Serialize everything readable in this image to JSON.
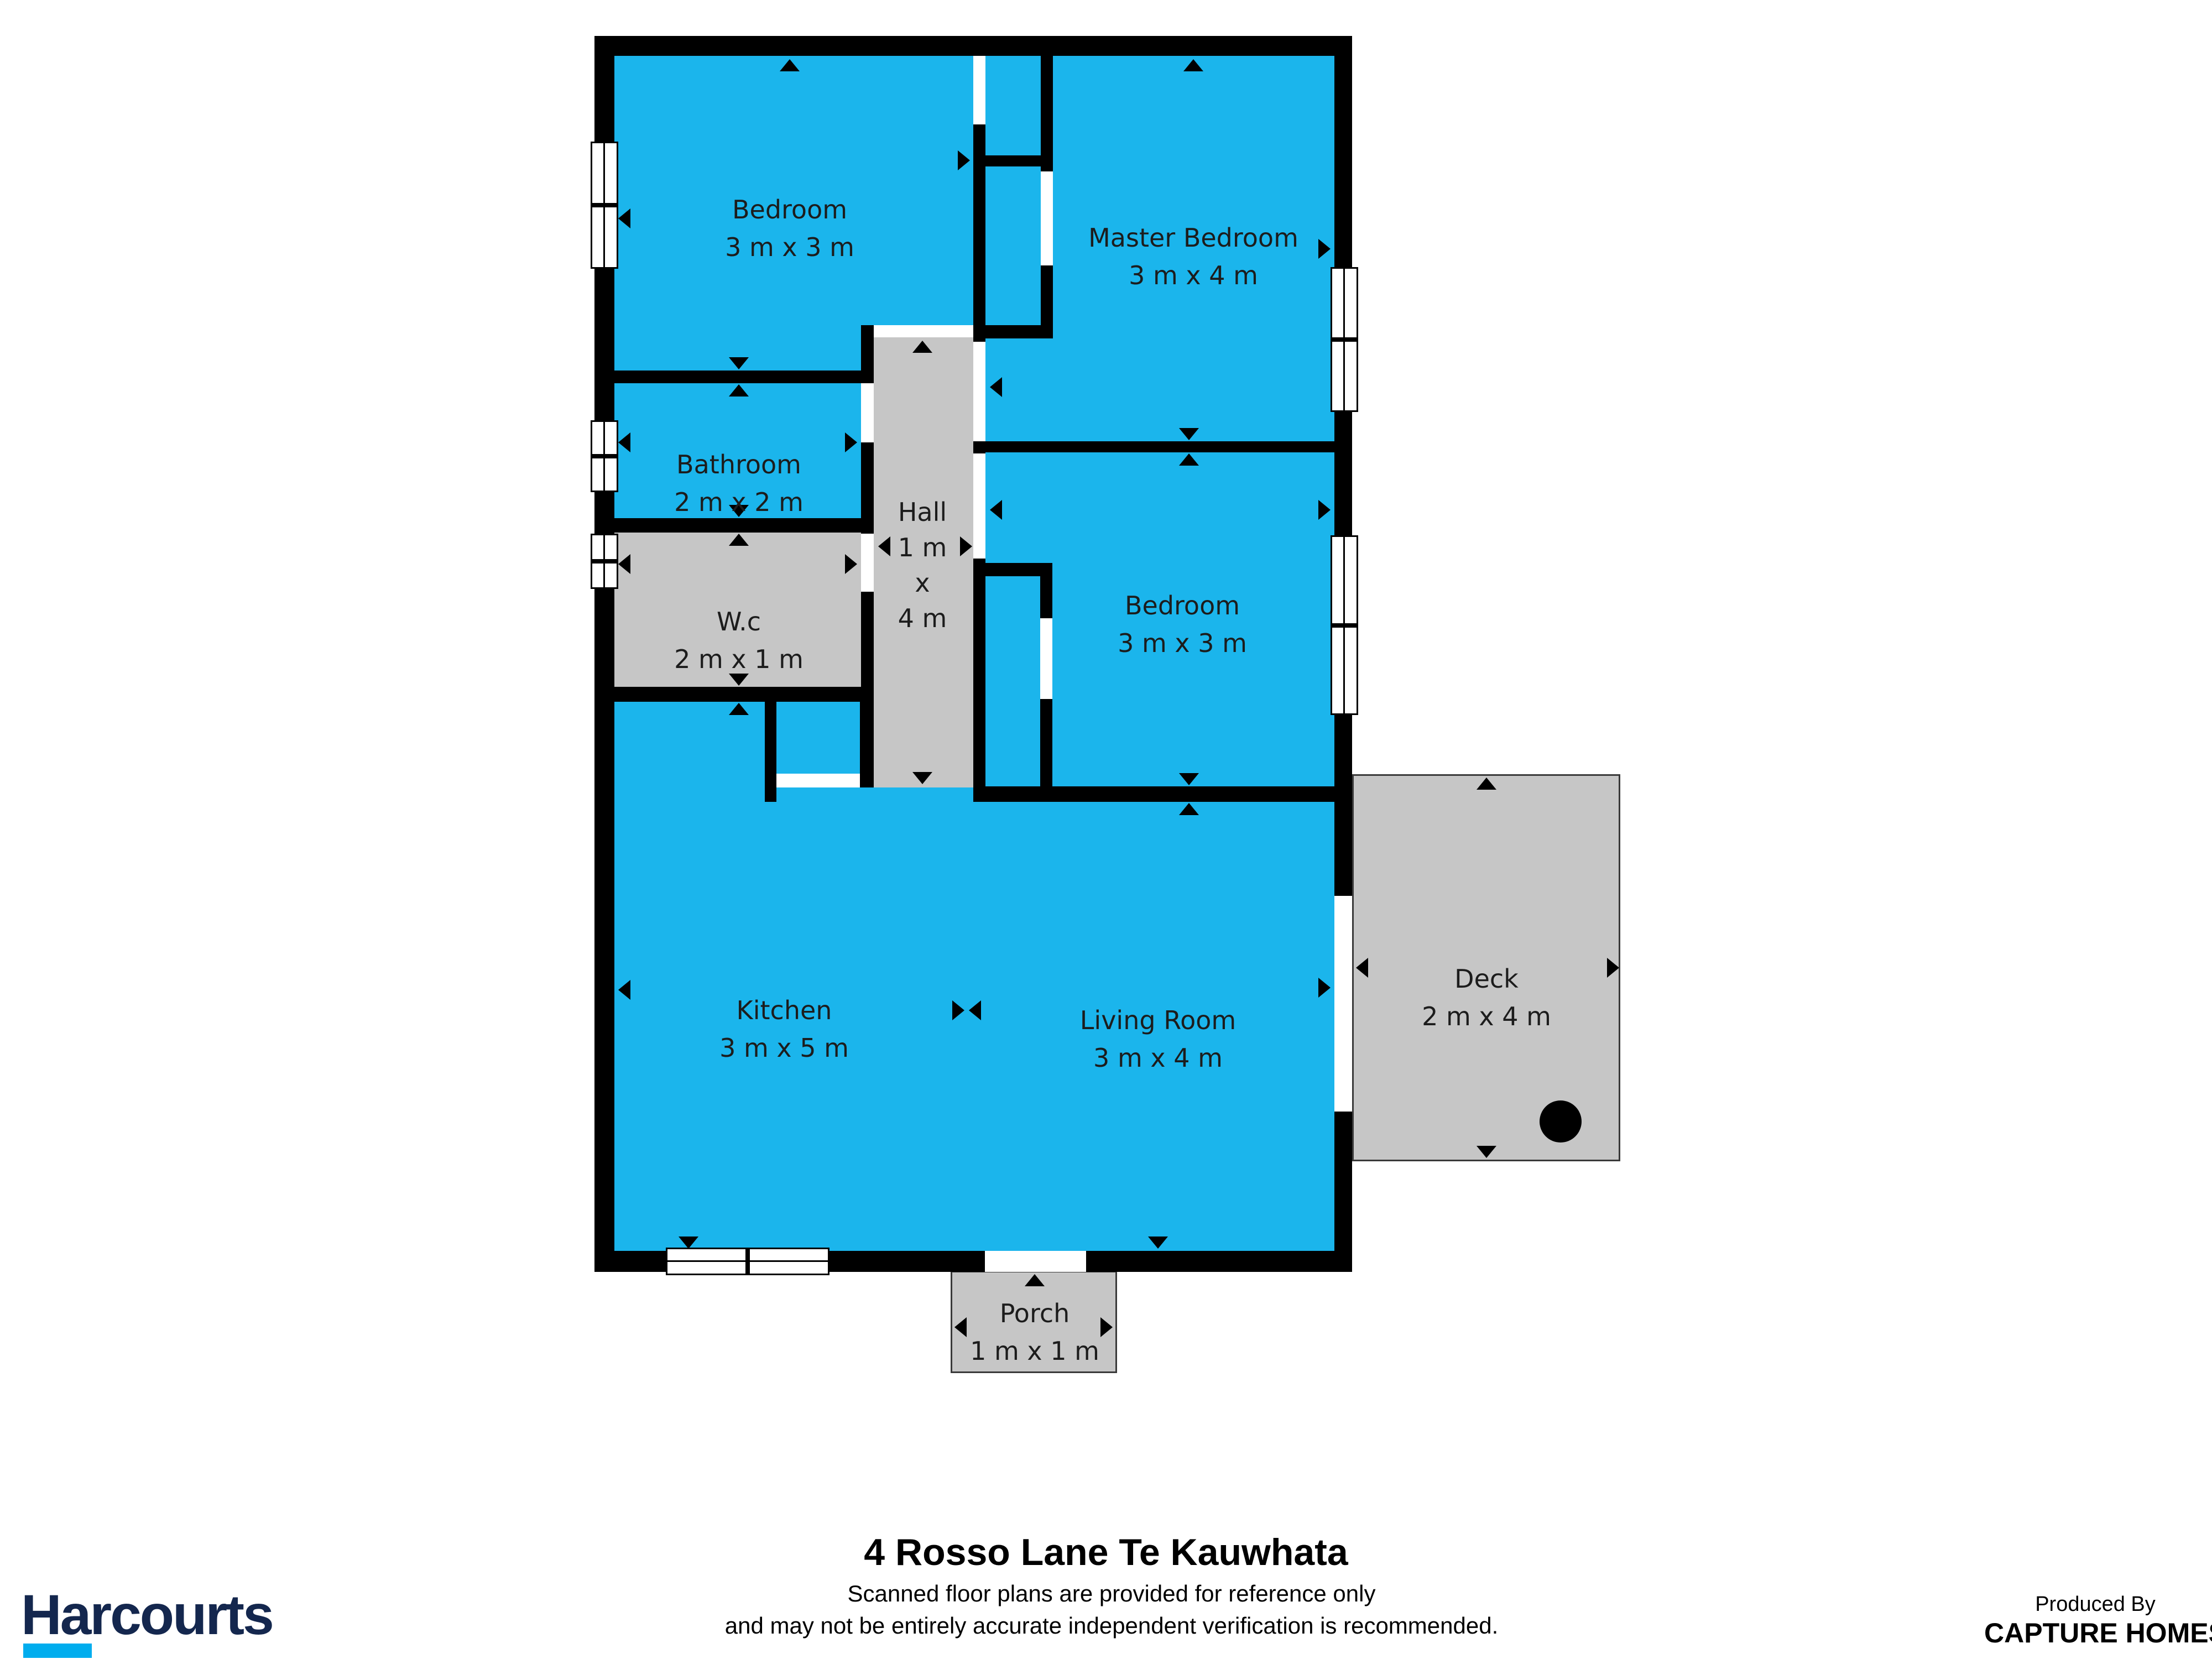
{
  "plan": {
    "rooms": {
      "bedroom1": {
        "name": "Bedroom",
        "dims": "3 m x 3 m"
      },
      "master": {
        "name": "Master Bedroom",
        "dims": "3 m x 4 m"
      },
      "bathroom": {
        "name": "Bathroom",
        "dims": "2 m x 2 m"
      },
      "wc": {
        "name": "W.c",
        "dims": "2 m x 1 m"
      },
      "hall": {
        "lines": [
          "Hall",
          "1 m",
          "x",
          "4 m"
        ]
      },
      "bedroom2": {
        "name": "Bedroom",
        "dims": "3 m x 3 m"
      },
      "kitchen": {
        "name": "Kitchen",
        "dims": "3 m x 5 m"
      },
      "living": {
        "name": "Living Room",
        "dims": "3 m x 4 m"
      },
      "deck": {
        "name": "Deck",
        "dims": "2 m x 4 m"
      },
      "porch": {
        "name": "Porch",
        "dims": "1 m x 1 m"
      }
    },
    "colors": {
      "room_fill": "#1BB5EC",
      "utility_fill": "#C6C6C6",
      "wall": "#000000",
      "brand_navy": "#14274E",
      "brand_cyan": "#00ADEE"
    }
  },
  "footer": {
    "title": "4 Rosso Lane Te Kauwhata",
    "disclaimer_line1": "Scanned floor plans are provided for reference only",
    "disclaimer_line2": "and may not be entirely accurate independent verification is recommended.",
    "brand": "Harcourts",
    "produced_by_label": "Produced By",
    "producer_name": "CAPTURE HOMES"
  }
}
